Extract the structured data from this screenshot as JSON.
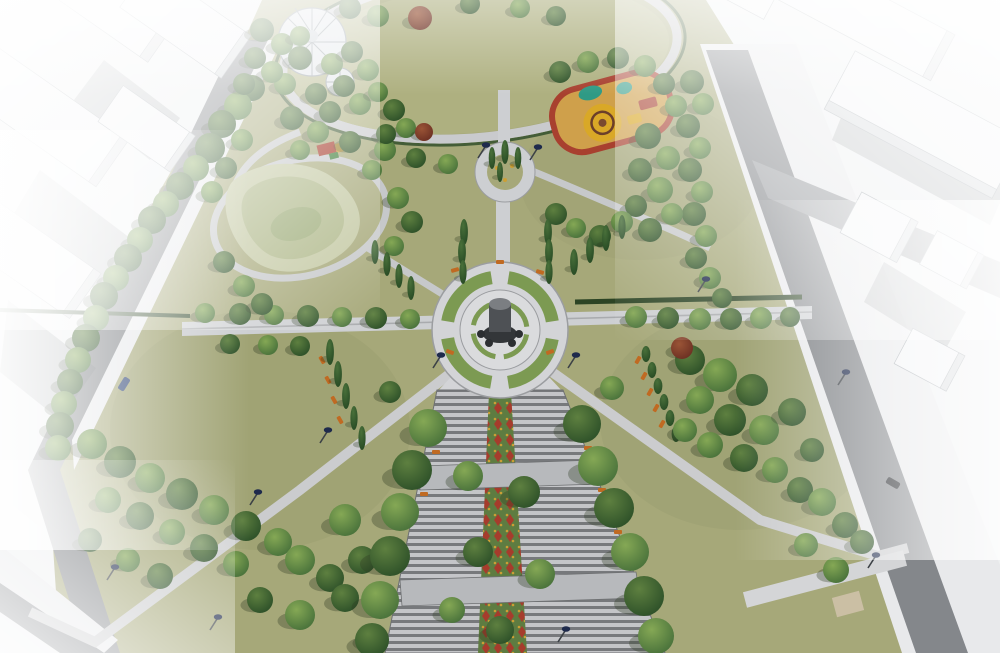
{
  "meta": {
    "subject": "aerial-3d-render-of-park-master-plan",
    "no_visible_text": true
  },
  "colors": {
    "bg": "#eef0f1",
    "grass": "#a6a879",
    "grassShade": "#8f9368",
    "lawn": "#aeb080",
    "road": "#84878b",
    "roadLight": "#9b9ea2",
    "sidewalk": "#e8e9eb",
    "curb": "#c2c4c7",
    "path": "#cdcfd2",
    "pathDim": "#b7b9bc",
    "building": "#f3f4f6",
    "buildingSide": "#d6d9dc",
    "buildingLine": "#a6acb1",
    "castShadow": "#5c6166",
    "terraceBase": "#8d8f92",
    "flowerGreen": "#5e7c41",
    "flowerRed": "#a63c2c",
    "flowerYellow": "#cc9f35",
    "hedge": "#2c4424",
    "bed": "#7c9a52",
    "plaza": "#d3d4d7",
    "plazaInner": "#dadbdd",
    "ringEdge": "#9b9da0",
    "monumentBase": "#333639",
    "monumentBody": "#4e5155",
    "monumentTop": "#7b7e82",
    "statue": "#2c2f32",
    "bench": "#c06a22",
    "lampHead": "#1e2a4c",
    "lampPole": "#3c4146",
    "playSand": "#cfa04b",
    "playRed": "#a8402f",
    "playYellow": "#d9a827",
    "playTeal": "#2f9a85",
    "playDark": "#4a4436",
    "dome": "#dfe3e7",
    "domeFrame": "#8d969c",
    "mound1": "#c3c8a2",
    "mound2": "#aeb788",
    "mound3": "#9cab77",
    "deck": "#cbbfa4"
  },
  "scene": {
    "trees_round": [
      [
        252,
        88,
        13,
        2
      ],
      [
        238,
        106,
        14,
        1
      ],
      [
        222,
        124,
        14,
        2
      ],
      [
        242,
        140,
        11,
        1
      ],
      [
        210,
        148,
        15,
        2
      ],
      [
        196,
        168,
        13,
        1
      ],
      [
        180,
        186,
        14,
        2
      ],
      [
        166,
        204,
        13,
        1
      ],
      [
        152,
        220,
        14,
        2
      ],
      [
        140,
        240,
        13,
        1
      ],
      [
        128,
        258,
        14,
        2
      ],
      [
        116,
        278,
        13,
        1
      ],
      [
        104,
        296,
        14,
        2
      ],
      [
        96,
        318,
        13,
        1
      ],
      [
        86,
        338,
        14,
        2
      ],
      [
        78,
        360,
        13,
        1
      ],
      [
        70,
        382,
        13,
        2
      ],
      [
        64,
        404,
        13,
        1
      ],
      [
        60,
        426,
        14,
        2
      ],
      [
        58,
        448,
        13,
        1
      ],
      [
        92,
        444,
        15,
        1
      ],
      [
        120,
        462,
        16,
        2
      ],
      [
        150,
        478,
        15,
        1
      ],
      [
        182,
        494,
        16,
        2
      ],
      [
        214,
        510,
        15,
        1
      ],
      [
        246,
        526,
        15,
        2
      ],
      [
        278,
        542,
        14,
        1
      ],
      [
        108,
        500,
        13,
        1
      ],
      [
        140,
        516,
        14,
        2
      ],
      [
        172,
        532,
        13,
        1
      ],
      [
        204,
        548,
        14,
        2
      ],
      [
        236,
        564,
        13,
        1
      ],
      [
        300,
        560,
        15,
        1
      ],
      [
        330,
        578,
        14,
        2
      ],
      [
        128,
        560,
        12,
        1
      ],
      [
        160,
        576,
        13,
        2
      ],
      [
        90,
        540,
        12,
        2
      ],
      [
        300,
        615,
        15,
        1
      ],
      [
        345,
        598,
        14,
        2
      ],
      [
        372,
        638,
        13,
        1
      ],
      [
        260,
        600,
        13,
        2
      ],
      [
        345,
        520,
        16,
        1
      ],
      [
        362,
        560,
        14,
        2
      ],
      [
        205,
        313,
        10,
        1
      ],
      [
        240,
        314,
        11,
        2
      ],
      [
        274,
        315,
        10,
        1
      ],
      [
        308,
        316,
        11,
        2
      ],
      [
        342,
        317,
        10,
        1
      ],
      [
        376,
        318,
        11,
        2
      ],
      [
        410,
        319,
        10,
        1
      ],
      [
        230,
        344,
        10,
        2
      ],
      [
        268,
        345,
        10,
        1
      ],
      [
        300,
        346,
        10,
        2
      ],
      [
        636,
        317,
        11,
        1
      ],
      [
        668,
        318,
        11,
        2
      ],
      [
        700,
        319,
        11,
        1
      ],
      [
        731,
        319,
        11,
        2
      ],
      [
        761,
        318,
        11,
        1
      ],
      [
        790,
        317,
        10,
        2
      ],
      [
        690,
        360,
        15,
        2
      ],
      [
        720,
        375,
        17,
        1
      ],
      [
        752,
        390,
        16,
        2
      ],
      [
        700,
        400,
        14,
        1
      ],
      [
        730,
        420,
        16,
        2
      ],
      [
        764,
        430,
        15,
        1
      ],
      [
        792,
        412,
        14,
        2
      ],
      [
        710,
        445,
        13,
        1
      ],
      [
        744,
        458,
        14,
        2
      ],
      [
        775,
        470,
        13,
        1
      ],
      [
        812,
        450,
        12,
        2
      ],
      [
        685,
        430,
        12,
        1
      ],
      [
        800,
        490,
        13,
        2
      ],
      [
        822,
        502,
        14,
        1
      ],
      [
        845,
        525,
        13,
        2
      ],
      [
        806,
        545,
        12,
        1
      ],
      [
        836,
        570,
        13,
        1
      ],
      [
        862,
        542,
        12,
        2
      ],
      [
        692,
        82,
        12,
        2
      ],
      [
        703,
        104,
        11,
        1
      ],
      [
        688,
        126,
        12,
        2
      ],
      [
        700,
        148,
        11,
        1
      ],
      [
        690,
        170,
        12,
        2
      ],
      [
        702,
        192,
        11,
        1
      ],
      [
        694,
        214,
        12,
        2
      ],
      [
        706,
        236,
        11,
        1
      ],
      [
        696,
        258,
        11,
        2
      ],
      [
        710,
        278,
        11,
        1
      ],
      [
        722,
        298,
        10,
        2
      ],
      [
        648,
        136,
        13,
        2
      ],
      [
        668,
        158,
        12,
        1
      ],
      [
        640,
        170,
        12,
        2
      ],
      [
        660,
        190,
        13,
        1
      ],
      [
        636,
        206,
        11,
        2
      ],
      [
        672,
        214,
        11,
        1
      ],
      [
        650,
        230,
        12,
        2
      ],
      [
        622,
        222,
        11,
        1
      ],
      [
        600,
        236,
        11,
        2
      ],
      [
        576,
        228,
        10,
        1
      ],
      [
        556,
        214,
        11,
        2
      ],
      [
        560,
        72,
        11,
        2
      ],
      [
        588,
        62,
        11,
        1
      ],
      [
        618,
        58,
        11,
        2
      ],
      [
        645,
        66,
        11,
        1
      ],
      [
        664,
        84,
        11,
        2
      ],
      [
        676,
        106,
        11,
        1
      ],
      [
        300,
        58,
        12,
        2
      ],
      [
        285,
        84,
        11,
        1
      ],
      [
        316,
        94,
        11,
        2
      ],
      [
        332,
        64,
        11,
        1
      ],
      [
        292,
        118,
        12,
        2
      ],
      [
        318,
        132,
        11,
        1
      ],
      [
        350,
        142,
        11,
        2
      ],
      [
        385,
        150,
        11,
        1
      ],
      [
        416,
        158,
        10,
        2
      ],
      [
        448,
        164,
        10,
        1
      ],
      [
        300,
        150,
        10,
        1
      ],
      [
        350,
        8,
        11,
        2
      ],
      [
        378,
        16,
        11,
        1
      ],
      [
        470,
        4,
        10,
        2
      ],
      [
        520,
        8,
        10,
        1
      ],
      [
        556,
        16,
        10,
        2
      ],
      [
        262,
        30,
        12,
        2
      ],
      [
        282,
        44,
        11,
        1
      ],
      [
        255,
        58,
        11,
        2
      ],
      [
        272,
        72,
        11,
        1
      ],
      [
        244,
        84,
        11,
        2
      ],
      [
        300,
        36,
        10,
        1
      ],
      [
        352,
        52,
        11,
        2
      ],
      [
        368,
        70,
        11,
        1
      ],
      [
        344,
        86,
        11,
        2
      ],
      [
        360,
        104,
        11,
        1
      ],
      [
        330,
        112,
        11,
        2
      ],
      [
        378,
        92,
        10,
        1
      ],
      [
        394,
        110,
        11,
        2
      ],
      [
        406,
        128,
        10,
        1
      ],
      [
        386,
        134,
        10,
        2
      ],
      [
        226,
        168,
        11,
        2
      ],
      [
        212,
        192,
        11,
        1
      ],
      [
        224,
        262,
        11,
        2
      ],
      [
        244,
        286,
        11,
        1
      ],
      [
        262,
        304,
        11,
        2
      ],
      [
        398,
        198,
        11,
        1
      ],
      [
        412,
        222,
        11,
        2
      ],
      [
        394,
        246,
        10,
        1
      ],
      [
        372,
        170,
        10,
        1
      ],
      [
        428,
        428,
        19,
        1
      ],
      [
        412,
        470,
        20,
        2
      ],
      [
        400,
        512,
        19,
        1
      ],
      [
        390,
        556,
        20,
        2
      ],
      [
        380,
        600,
        19,
        1
      ],
      [
        372,
        640,
        17,
        2
      ],
      [
        582,
        424,
        19,
        2
      ],
      [
        598,
        466,
        20,
        1
      ],
      [
        614,
        508,
        20,
        2
      ],
      [
        630,
        552,
        19,
        1
      ],
      [
        644,
        596,
        20,
        2
      ],
      [
        656,
        636,
        18,
        1
      ],
      [
        468,
        476,
        15,
        1
      ],
      [
        524,
        492,
        16,
        2
      ],
      [
        478,
        552,
        15,
        2
      ],
      [
        540,
        574,
        15,
        1
      ],
      [
        500,
        630,
        14,
        2
      ],
      [
        452,
        610,
        13,
        1
      ],
      [
        612,
        388,
        12,
        1
      ],
      [
        390,
        392,
        11,
        2
      ]
    ],
    "trees_cypress": [
      [
        464,
        232,
        13
      ],
      [
        462,
        252,
        13
      ],
      [
        463,
        272,
        12
      ],
      [
        548,
        232,
        13
      ],
      [
        549,
        252,
        13
      ],
      [
        549,
        272,
        12
      ],
      [
        492,
        158,
        11
      ],
      [
        505,
        152,
        12
      ],
      [
        518,
        158,
        11
      ],
      [
        500,
        172,
        10
      ],
      [
        574,
        262,
        13
      ],
      [
        590,
        250,
        13
      ],
      [
        606,
        238,
        13
      ],
      [
        622,
        227,
        12
      ],
      [
        375,
        252,
        12
      ],
      [
        387,
        264,
        12
      ],
      [
        399,
        276,
        12
      ],
      [
        411,
        288,
        12
      ],
      [
        330,
        352,
        13
      ],
      [
        338,
        374,
        13
      ],
      [
        346,
        396,
        13
      ],
      [
        354,
        418,
        12
      ],
      [
        362,
        438,
        12
      ]
    ],
    "trees_red": [
      [
        420,
        18,
        12
      ],
      [
        682,
        348,
        11
      ],
      [
        424,
        132,
        9
      ]
    ],
    "shrub_cones": [
      [
        646,
        354,
        8
      ],
      [
        652,
        370,
        8
      ],
      [
        658,
        386,
        8
      ],
      [
        664,
        402,
        8
      ],
      [
        670,
        418,
        8
      ],
      [
        676,
        434,
        8
      ]
    ],
    "lamps": [
      [
        478,
        158
      ],
      [
        530,
        160
      ],
      [
        433,
        368
      ],
      [
        568,
        368
      ],
      [
        320,
        443
      ],
      [
        250,
        505
      ],
      [
        107,
        580
      ],
      [
        210,
        630
      ],
      [
        558,
        642
      ],
      [
        838,
        385
      ],
      [
        868,
        568
      ],
      [
        698,
        292
      ]
    ],
    "benches": [
      [
        455,
        270,
        -15
      ],
      [
        500,
        262,
        0
      ],
      [
        540,
        272,
        15
      ],
      [
        450,
        352,
        20
      ],
      [
        550,
        352,
        -20
      ],
      [
        322,
        360,
        60
      ],
      [
        328,
        380,
        60
      ],
      [
        334,
        400,
        60
      ],
      [
        340,
        420,
        60
      ],
      [
        638,
        360,
        -60
      ],
      [
        644,
        376,
        -60
      ],
      [
        650,
        392,
        -60
      ],
      [
        656,
        408,
        -60
      ],
      [
        662,
        424,
        -60
      ],
      [
        588,
        448,
        0
      ],
      [
        602,
        490,
        0
      ],
      [
        618,
        532,
        0
      ],
      [
        436,
        452,
        0
      ],
      [
        424,
        494,
        0
      ]
    ],
    "cars": [
      [
        124,
        384,
        -58,
        "#2e4474"
      ],
      [
        893,
        483,
        30,
        "#23262a"
      ]
    ]
  }
}
